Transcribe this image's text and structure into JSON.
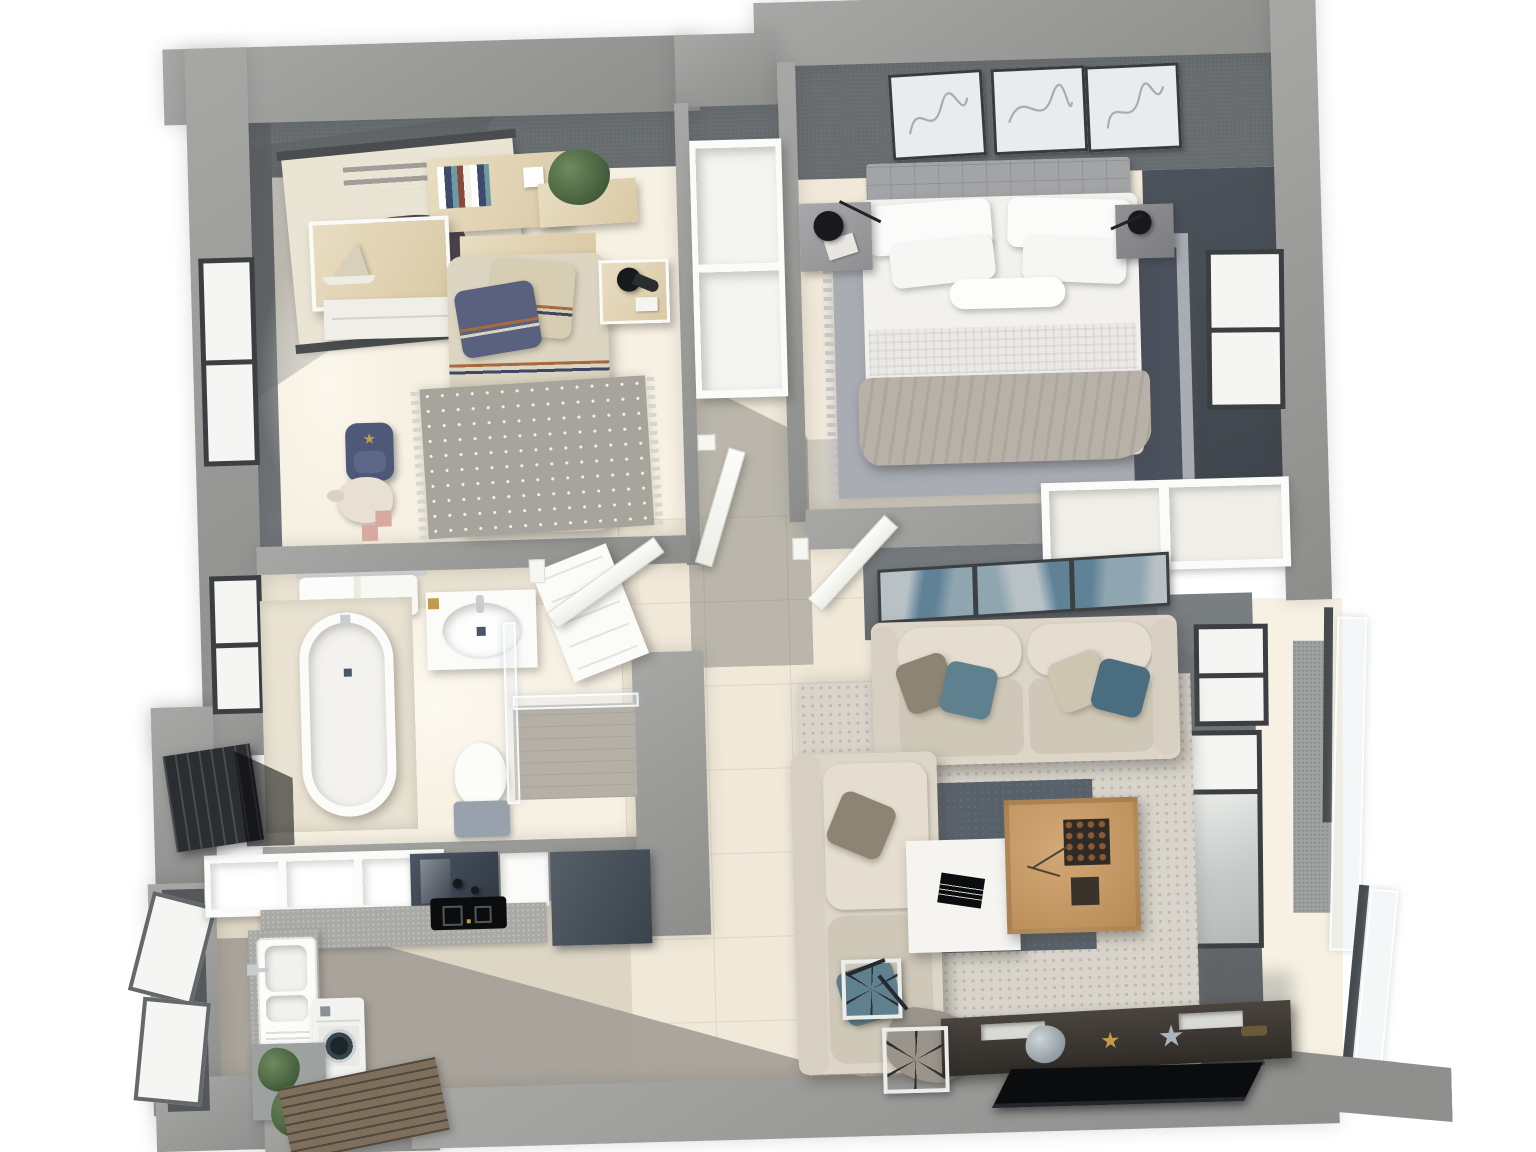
{
  "meta": {
    "description": "Top-down 3D architectural render of a two-bedroom apartment floor plan",
    "view": "bird's-eye dollhouse cutaway, no visible text labels"
  },
  "palette": {
    "canvas": "#ffffff",
    "wallA": "#a7a8a6",
    "wallB": "#8d8e8c",
    "wallFace": "#676c6f",
    "wallFaceDark": "#51575c",
    "wallNavy": "#4d535b",
    "tileLine": "rgba(150,140,122,.20)",
    "floorCream": "#f0e8d8",
    "floorBright": "#f7f1e3",
    "floorKitchen": "#ded6c5",
    "concrete": "#a39f96",
    "white": "#fbfbfa",
    "offWhite": "#f0eee8",
    "woodLight": "#e9ddc1",
    "woodEdge": "#d9c9a6",
    "navyPillow": "#59617f",
    "navyBlanket": "#47516c",
    "beigeDuvet": "#dcd5c2",
    "beigePillow": "#d7cdb2",
    "stripeOrange": "#a8693f",
    "stripeNavy": "#3e4765",
    "rugKids": "#a7a49c",
    "rugFringe": "#d8d5ce",
    "sofa": "#ddd6c8",
    "sofaDark": "#cfc8b8",
    "teal": "#5e808f",
    "tealDark": "#4a6d80",
    "pillowGray": "#8d8473",
    "throwSofa": "#9a948a",
    "rugBig": "#d8d4cb",
    "rugSmall": "#59626c",
    "tableWhite": "#f5f4f1",
    "tableWood": "#d2a877",
    "tableWoodDark": "#b98c55",
    "tvWoodA": "#4a443e",
    "tvWoodB": "#2f2b27",
    "tvBlack": "#0b0c0d",
    "carpetMaster": "#a9adb3",
    "runner": "#4b525e",
    "throwBed": "#b7b1a8",
    "headboardGray": "#a3a4a6",
    "bedWhite": "#f2f1ee",
    "frameDark": "#3b3f42",
    "glass": "#f5f6f3",
    "glassTint": "#dfe3e3",
    "chrome": "#c9cdd0",
    "marble": "#a9a9a6",
    "cabDark1": "#4b5563",
    "cabDark2": "#2f3741",
    "doorSlat": "#2b2e31",
    "matWood": "#7d6f5c",
    "plantA": "#6f8a5e",
    "plantB": "#3f5a38",
    "art1": "#b7c1c6",
    "art2": "#8fa5b0",
    "art3": "#5f8296",
    "tileBath": "#e9e2d2",
    "tankGray": "#99a1ac",
    "showerFloor": "#b5b0a6",
    "gold": "#c29b4a",
    "silver": "#aab4bd",
    "stone": "#9da2a0",
    "washerDoor": "#35454e"
  },
  "scene": {
    "rooms": [
      {
        "name": "kids-bedroom",
        "items": [
          "elephant-poster",
          "book-shelf",
          "plant-shelf",
          "desk-dresser",
          "single-bed",
          "striped-pillows",
          "knit-blanket",
          "nightstand-lamp",
          "polka-dot-rug",
          "backpack",
          "plush-toy",
          "window"
        ]
      },
      {
        "name": "master-bedroom",
        "items": [
          "three-line-art-frames",
          "tufted-headboard",
          "double-bed",
          "white-pillows",
          "gray-throw",
          "nightstand-left",
          "nightstand-right",
          "black-wall-lamps",
          "area-carpet",
          "dark-runner",
          "window",
          "built-in-closet"
        ]
      },
      {
        "name": "hallway",
        "items": [
          "open-wardrobe",
          "kids-door",
          "master-door",
          "bathroom-door"
        ]
      },
      {
        "name": "bathroom",
        "items": [
          "bathtub",
          "vanity-sink",
          "toilet",
          "walk-in-shower",
          "towel-rail",
          "window"
        ]
      },
      {
        "name": "kitchen-entry",
        "items": [
          "upper-cabinets",
          "glossy-dark-cabinet",
          "tall-dark-unit",
          "cooktop",
          "stone-counter",
          "double-sink",
          "washing-machine",
          "potted-plants",
          "wood-doormat",
          "slatted-niche-panel",
          "open-casement-windows"
        ]
      },
      {
        "name": "living-room",
        "items": [
          "panoramic-triptych-art",
          "main-sofa",
          "side-sofa",
          "round-rug-large",
          "round-rug-small",
          "white-coffee-table",
          "wood-coffee-table",
          "decor-bowls",
          "tv-console",
          "flat-tv",
          "bicycle",
          "windows"
        ]
      },
      {
        "name": "balcony",
        "items": [
          "tile-floor",
          "speckled-pillar",
          "glass-railing",
          "parapet-slab"
        ]
      }
    ]
  }
}
